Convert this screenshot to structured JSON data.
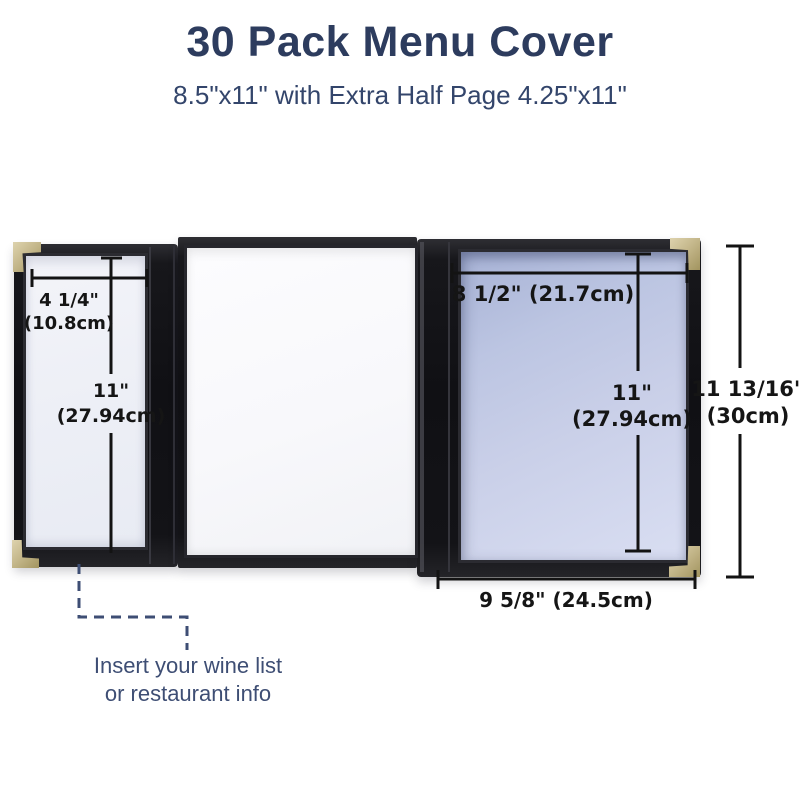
{
  "header": {
    "title": "30 Pack Menu Cover",
    "subtitle": "8.5\"x11\" with Extra Half Page 4.25\"x11\""
  },
  "dimensions": {
    "half_page_width": {
      "inches": "4 1/4\"",
      "metric": "(10.8cm)"
    },
    "half_page_height": {
      "inches": "11\"",
      "metric": "(27.94cm)"
    },
    "full_page_width": {
      "label": "8 1/2\" (21.7cm)"
    },
    "full_page_height": {
      "inches": "11\"",
      "metric": "(27.94cm)"
    },
    "cover_height": {
      "inches": "11 13/16\"",
      "metric": "(30cm)"
    },
    "cover_width": {
      "label": "9 5/8\" (24.5cm)"
    }
  },
  "callout": {
    "line1": "Insert your wine list",
    "line2": "or restaurant info"
  },
  "colors": {
    "title_navy": "#2d3c5e",
    "callout_navy": "#3e4e74",
    "dimension_text": "#151515",
    "vinyl_black": "#141417",
    "gold_corner": "#c5b88c",
    "left_page": "#edeff6",
    "middle_page": "#f8f8fb",
    "right_page_tint": "#c9cfe8"
  }
}
